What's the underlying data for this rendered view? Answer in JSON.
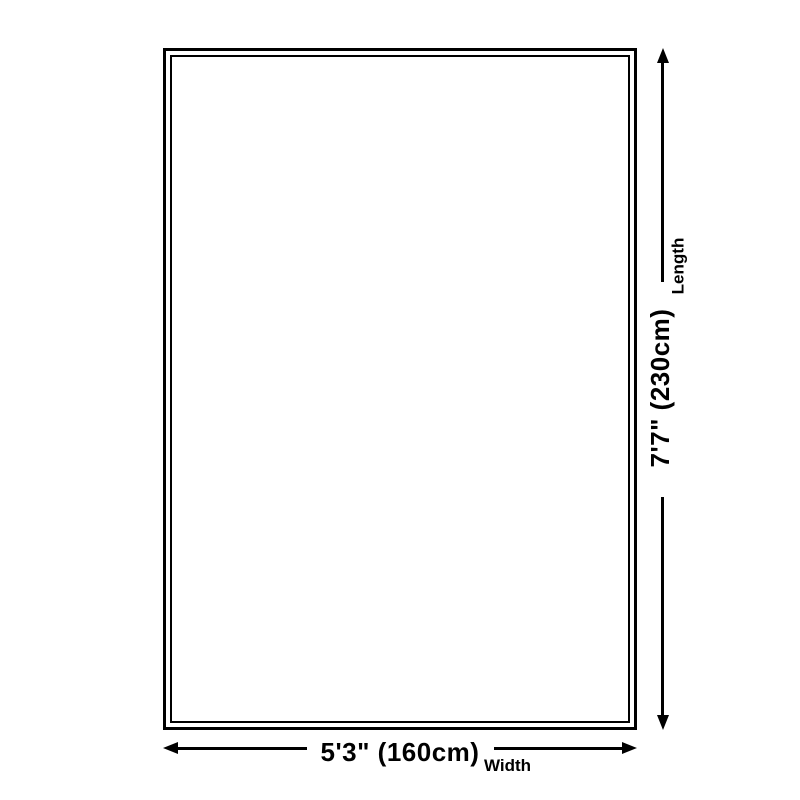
{
  "diagram": {
    "type": "rug-size-diagram",
    "colors": {
      "background": "#ffffff",
      "line": "#000000",
      "text": "#000000"
    },
    "dimensions": {
      "width": {
        "value": "5'3\" (160cm)",
        "label": "Width"
      },
      "length": {
        "value": "7'7\" (230cm)",
        "label": "Length"
      }
    }
  }
}
